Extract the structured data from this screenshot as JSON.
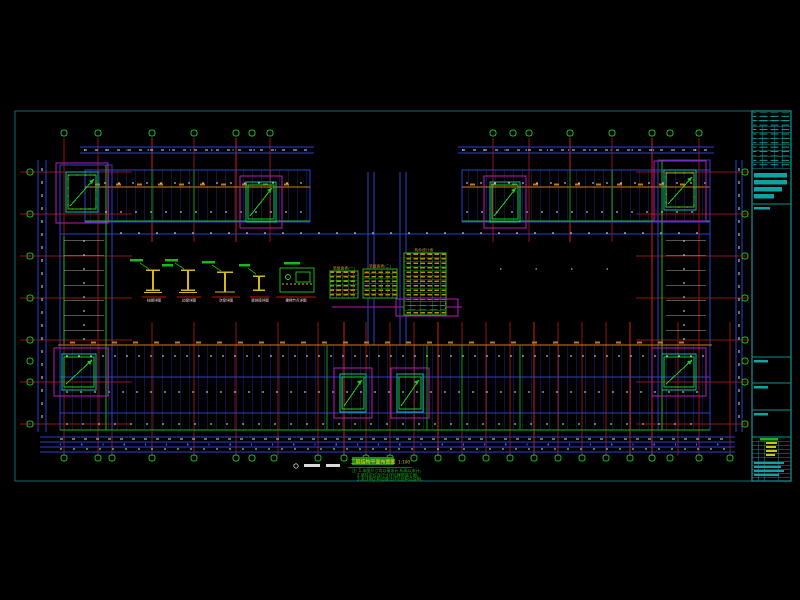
{
  "colors": {
    "background": "#000000",
    "sheet_frame_teal": "#0c6b6b",
    "title_block_cyan": "#0da3a3",
    "grid_red": "#8f1313",
    "grid_red_bright": "#d02020",
    "beam_blue": "#2d3fd0",
    "outline_green": "#18b818",
    "stair_magenta": "#bb1abb",
    "beam_orange": "#cf7d14",
    "table_text_yellow": "#c08a10",
    "dimension_white": "#d9dde2"
  },
  "tables": {
    "table_a_title": "梁截面表(一)",
    "table_b_title": "梁截面表(二)",
    "table_c_title": "构件统计表"
  },
  "details": {
    "captions": [
      "柱脚详图",
      "边梁详图",
      "次梁详图",
      "梁拼接详图",
      "楼梯节点详图"
    ]
  },
  "footer": {
    "drawing_title": "二层结构平面布置图",
    "title_scale": "1:100",
    "notes": {
      "line1": "注: 1.本图尺寸均以毫米计,标高以米计。",
      "line2": "2.梁柱定位及尺寸详见建筑施工图。",
      "line3": "3.未注明之构造做法详见结构总说明。"
    }
  }
}
